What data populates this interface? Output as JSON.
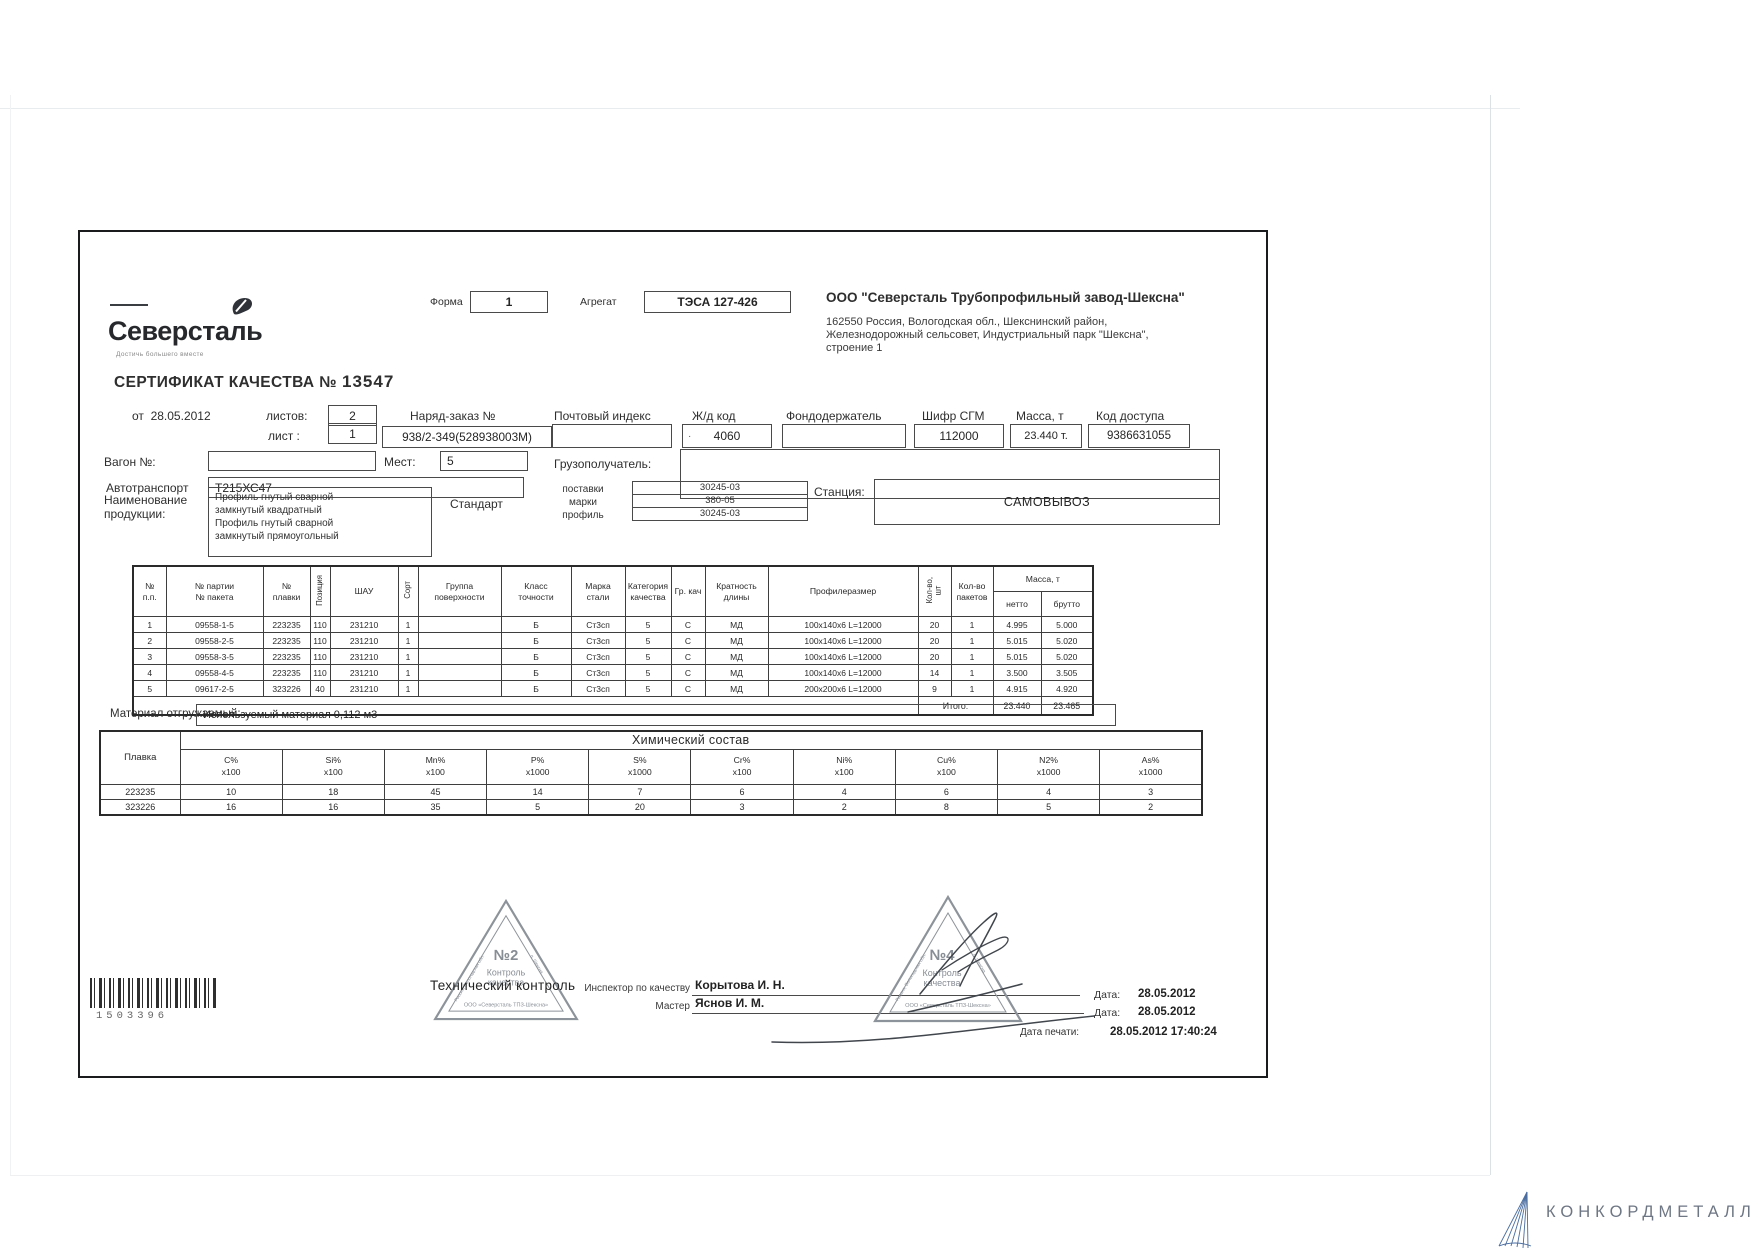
{
  "colors": {
    "ink": "#2f2f2f",
    "frame": "#1a1b1d",
    "stamp_gray": "#8d939a",
    "signature_ink": "#41464d",
    "footer_text": "#6e7684",
    "footer_icon_blue": "#4a6da0"
  },
  "scan": {
    "logo": {
      "brand": "Северсталь",
      "tagline": "Достичь большего вместе"
    },
    "form": {
      "label": "Форма",
      "value": "1"
    },
    "aggregate": {
      "label": "Агрегат",
      "value": "ТЭСА 127-426"
    },
    "company": {
      "name": "ООО \"Северсталь Трубопрофильный завод-Шексна\"",
      "address_lines": [
        "162550 Россия, Вологодская обл., Шекснинский район,",
        "Железнодорожный сельсовет, Индустриальный парк \"Шексна\",",
        "строение 1"
      ]
    },
    "title": {
      "label": "СЕРТИФИКАТ КАЧЕСТВА №",
      "number": "13547"
    },
    "meta": {
      "from_label": "от",
      "from_date": "28.05.2012",
      "sheets_label": "листов:",
      "sheets_value": "2",
      "sheet_label": "лист :",
      "sheet_value": "1",
      "order_label": "Наряд-заказ №",
      "order_value": "938/2-349(528938003М)",
      "postal_label": "Почтовый индекс",
      "postal_value": "",
      "rail_label": "Ж/д код",
      "rail_mark": "·",
      "rail_value": "4060",
      "holder_label": "Фондодержатель",
      "holder_value": "",
      "sgm_label": "Шифр СГМ",
      "sgm_value": "112000",
      "mass_label": "Масса, т",
      "mass_value": "23.440 т.",
      "access_label": "Код доступа",
      "access_value": "9386631055",
      "wagon_label": "Вагон №:",
      "wagon_value": "",
      "places_label": "Мест:",
      "places_value": "5",
      "consignee_label": "Грузополучатель:",
      "consignee_value": "",
      "transport_label": "Автотранспорт",
      "transport_value": "Т215ХС47",
      "product_label": "Наименование\nпродукции:",
      "product_lines": [
        "Профиль гнутый сварной",
        "замкнутый квадратный",
        "Профиль гнутый сварной",
        "замкнутый прямоугольный"
      ],
      "standard_label": "Стандарт",
      "standard_rows": [
        {
          "label": "поставки",
          "value": "30245-03"
        },
        {
          "label": "марки",
          "value": "380-05"
        },
        {
          "label": "профиль",
          "value": "30245-03"
        }
      ],
      "station_label": "Станция:",
      "station_value": "САМОВЫВОЗ"
    },
    "main_table": {
      "headers": [
        "№\nп.п.",
        "№ партии\n№ пакета",
        "№\nплавки",
        "Позиция",
        "ШАУ",
        "Сорт",
        "Группа\nповерхности",
        "Класс\nточности",
        "Марка\nстали",
        "Категория\nкачества",
        "Гр. кач",
        "Кратность\nдлины",
        "Профилеразмер",
        "Кол-во,\nшт",
        "Кол-во\nпакетов"
      ],
      "mass_header": "Масса, т",
      "netto_label": "нетто",
      "brutto_label": "брутто",
      "rows": [
        [
          "1",
          "09558-1-5",
          "223235",
          "110",
          "231210",
          "1",
          "",
          "Б",
          "Ст3сп",
          "5",
          "С",
          "МД",
          "100х140х6 L=12000",
          "20",
          "1",
          "4.995",
          "5.000"
        ],
        [
          "2",
          "09558-2-5",
          "223235",
          "110",
          "231210",
          "1",
          "",
          "Б",
          "Ст3сп",
          "5",
          "С",
          "МД",
          "100х140х6 L=12000",
          "20",
          "1",
          "5.015",
          "5.020"
        ],
        [
          "3",
          "09558-3-5",
          "223235",
          "110",
          "231210",
          "1",
          "",
          "Б",
          "Ст3сп",
          "5",
          "С",
          "МД",
          "100х140х6 L=12000",
          "20",
          "1",
          "5.015",
          "5.020"
        ],
        [
          "4",
          "09558-4-5",
          "223235",
          "110",
          "231210",
          "1",
          "",
          "Б",
          "Ст3сп",
          "5",
          "С",
          "МД",
          "100х140х6 L=12000",
          "14",
          "1",
          "3.500",
          "3.505"
        ],
        [
          "5",
          "09617-2-5",
          "323226",
          "40",
          "231210",
          "1",
          "",
          "Б",
          "Ст3сп",
          "5",
          "С",
          "МД",
          "200х200х6 L=12000",
          "9",
          "1",
          "4.915",
          "4.920"
        ]
      ],
      "total_label": "Итого:",
      "total_netto": "23.440",
      "total_brutto": "23.465"
    },
    "material": {
      "label": "Материал отгружаемый:",
      "value": "Используемый материал 0,112 м3"
    },
    "chem_table": {
      "title": "Химический состав",
      "heat_label": "Плавка",
      "element_headers": [
        "C%\nх100",
        "Si%\nх100",
        "Mn%\nх100",
        "P%\nх1000",
        "S%\nх1000",
        "Cr%\nх100",
        "Ni%\nх100",
        "Cu%\nх100",
        "N2%\nх1000",
        "As%\nх1000"
      ],
      "rows": [
        {
          "heat": "223235",
          "values": [
            "10",
            "18",
            "45",
            "14",
            "7",
            "6",
            "4",
            "6",
            "4",
            "3"
          ]
        },
        {
          "heat": "323226",
          "values": [
            "16",
            "16",
            "35",
            "5",
            "20",
            "3",
            "2",
            "8",
            "5",
            "2"
          ]
        }
      ]
    },
    "stamps": {
      "overlay": "Технический контроль",
      "stamp2": {
        "number": "№2",
        "line1": "Контроль",
        "line2": "качества",
        "base": "ООО «Северсталь ТПЗ-Шексна»",
        "edge_left": "Россия, Вологодская обл.",
        "edge_right": "п. Шексна"
      },
      "stamp4": {
        "number": "№4",
        "line1": "Контроль",
        "line2": "качества",
        "base": "ООО «Северсталь ТПЗ-Шексна»",
        "edge_left": "Россия, Вологодская обл.",
        "edge_right": "п. Шексна"
      }
    },
    "signatures": {
      "inspector_label": "Инспектор по качеству",
      "inspector_name": "Корытова И. Н.",
      "master_label": "Мастер",
      "master_name": "Яснов И. М."
    },
    "dates": [
      {
        "label": "Дата:",
        "value": "28.05.2012"
      },
      {
        "label": "Дата:",
        "value": "28.05.2012"
      },
      {
        "label": "Дата печати:",
        "value": "28.05.2012 17:40:24"
      }
    ],
    "barcode": {
      "number": "1503396"
    }
  },
  "footer": {
    "brand": "КОНКОРДМЕТАЛЛ"
  }
}
